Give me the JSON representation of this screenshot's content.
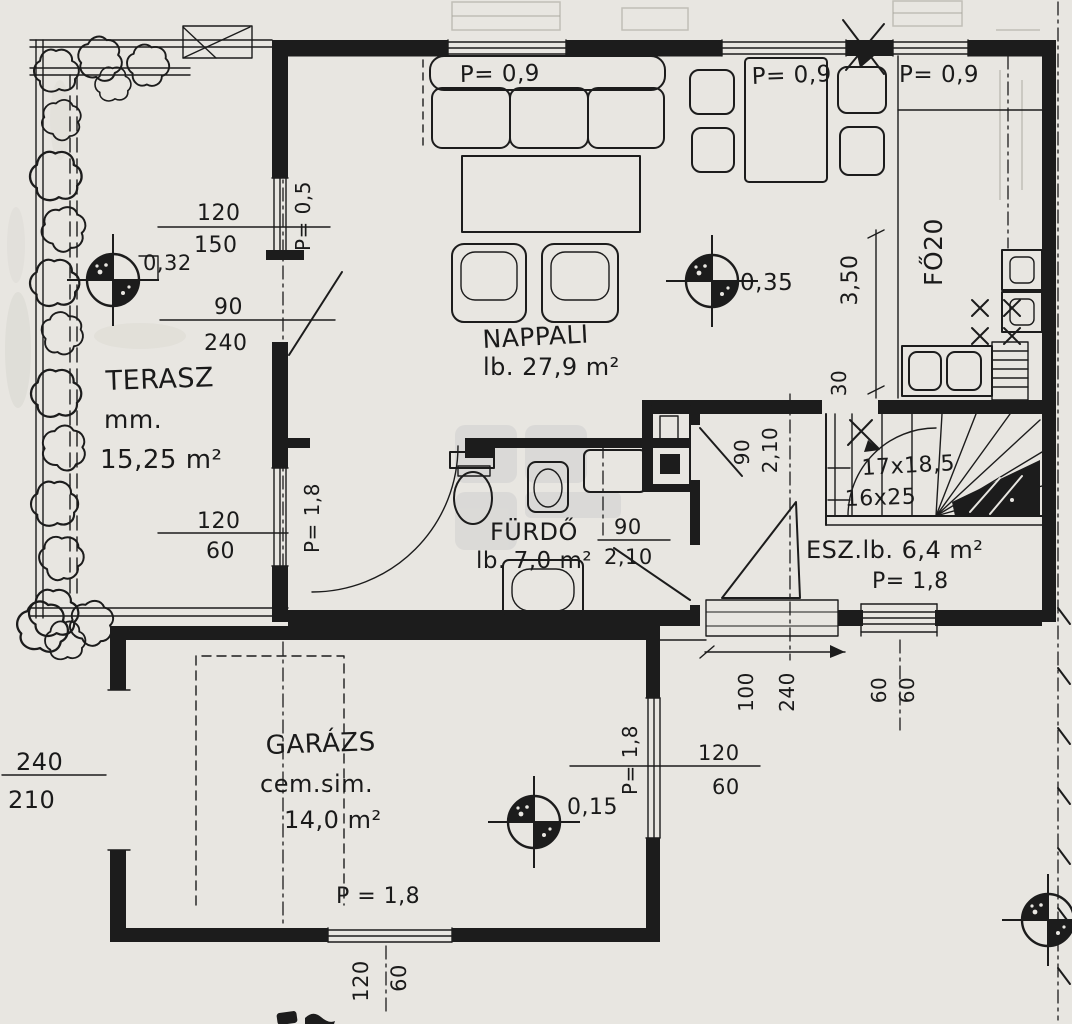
{
  "plan": {
    "rooms": {
      "terasz": {
        "name": "TERASZ",
        "material": "mm.",
        "area": "15,25 m²"
      },
      "nappali": {
        "name": "NAPPALI",
        "area": "lb. 27,9 m²"
      },
      "furdo": {
        "name": "FÜRDŐ",
        "area": "lb. 7,0 m²"
      },
      "eloszoba": {
        "name": "ESZ.lb. 6,4 m²",
        "parapet": "P= 1,8"
      },
      "garazs": {
        "name": "GARÁZS",
        "material": "cem.sim.",
        "area": "14,0 m²"
      }
    },
    "parapets": {
      "sofa_window": "P= 0,9",
      "dining_window": "P= 0,9",
      "kitchen_window": "P= 0,9",
      "terrace_door": "P= 0,5",
      "bath_window": "P= 1,8",
      "garage_hall_window": "P= 1,8",
      "garage_window": "P = 1,8"
    },
    "levels": {
      "terrace": "0,32",
      "living": "0,35",
      "garage": "0,15"
    },
    "stairs": {
      "run1": "17x18,5",
      "run2": "16x25"
    },
    "kitchen_note": "FŐ20",
    "dims": {
      "terrace_window_w": "120",
      "terrace_window_h": "150",
      "terrace_door_w": "90",
      "terrace_door_h": "240",
      "bath_window_w": "120",
      "bath_window_h": "60",
      "kitchen_wall": "3,50",
      "stair_pass": "30",
      "wc_door_w": "90",
      "wc_door_h": "2,10",
      "bath_door_w": "90",
      "bath_door_h": "2,10",
      "entry_door_w": "100",
      "entry_door_h": "240",
      "hall_window_a": "60",
      "hall_window_b": "60",
      "hall_pass_w": "120",
      "hall_pass_h": "60",
      "garage_door_w": "240",
      "garage_door_h": "210",
      "garage_window_w": "120",
      "garage_window_h": "60"
    }
  }
}
